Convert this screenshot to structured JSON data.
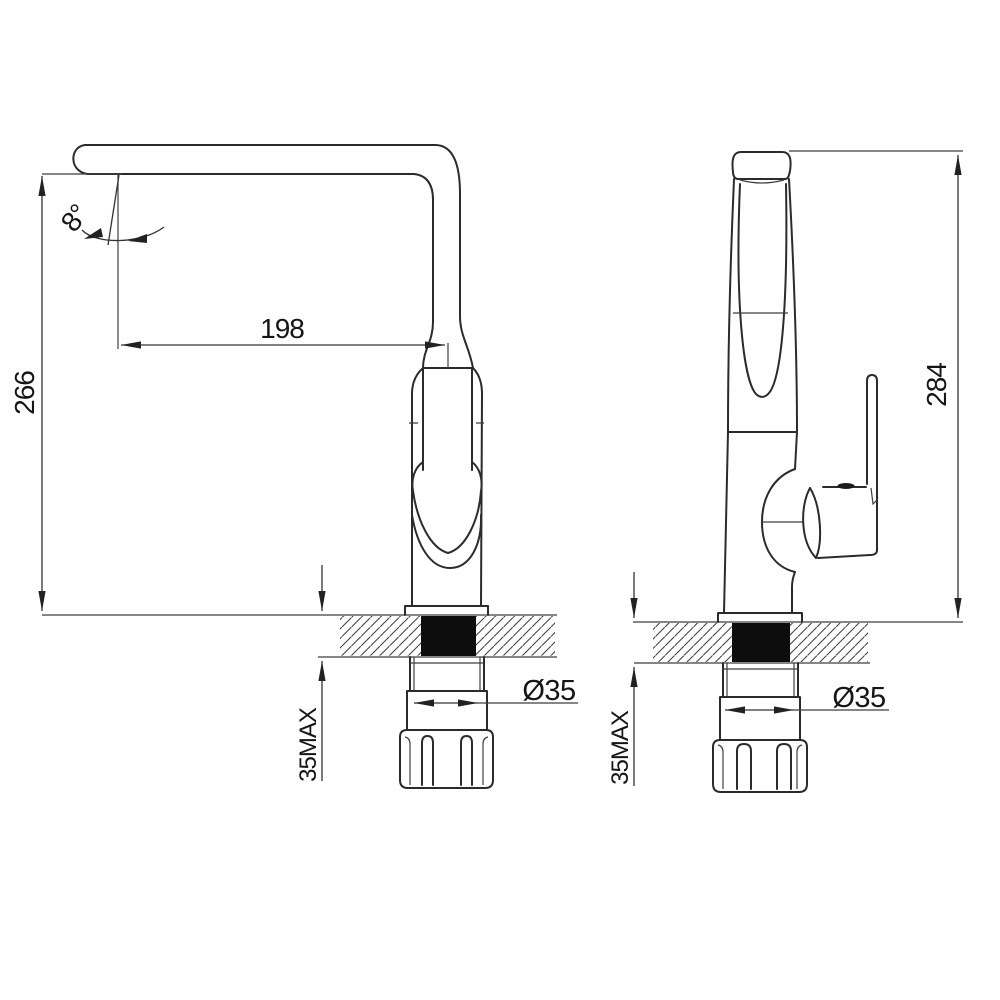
{
  "meta": {
    "drawing_type": "faucet installation technical drawing",
    "colors": {
      "background": "#ffffff",
      "line": "#2b2b2b",
      "text": "#151515",
      "hole_fill": "#0d0d0d"
    }
  },
  "side_view": {
    "dims": {
      "spout_reach": "198",
      "spout_height": "266",
      "spout_angle": "8°",
      "max_counter_thickness": "35MAX",
      "hole_diameter": "Ø35"
    }
  },
  "front_view": {
    "dims": {
      "overall_height": "284",
      "max_counter_thickness": "35MAX",
      "hole_diameter": "Ø35"
    }
  }
}
